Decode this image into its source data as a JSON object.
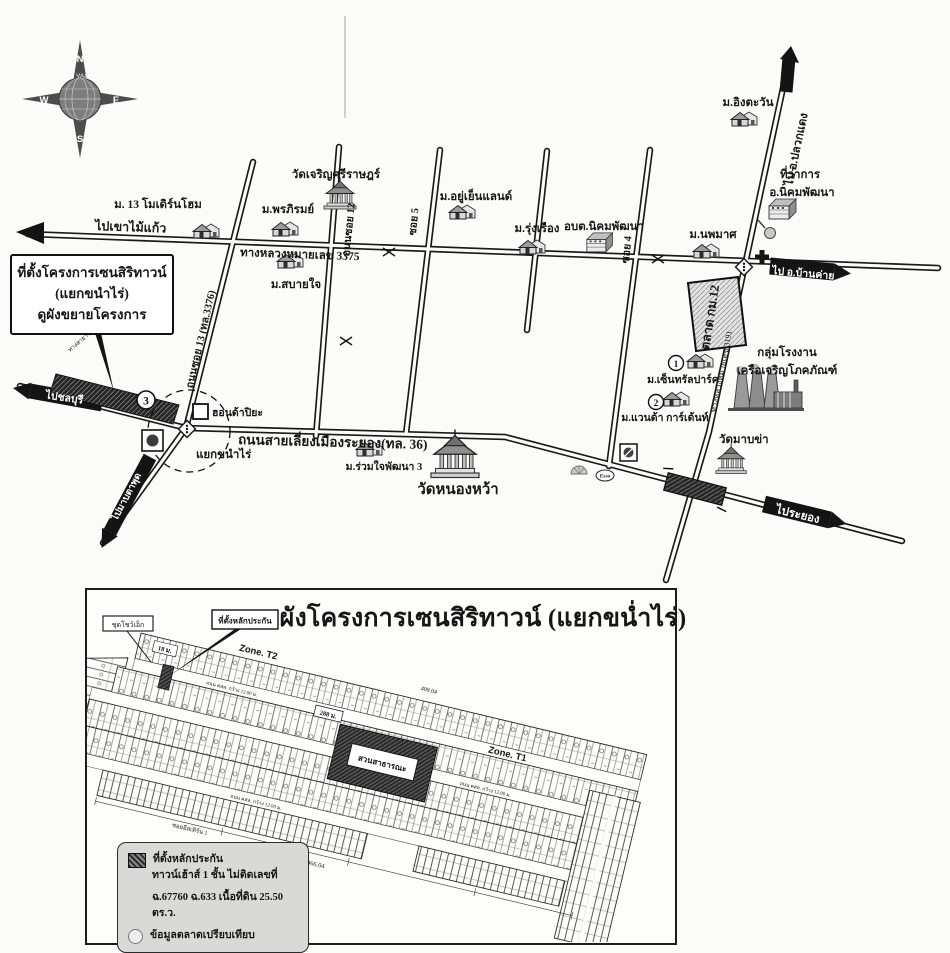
{
  "compass": {
    "n": "N",
    "e": "E",
    "s": "S",
    "w": "W",
    "brand": "WORLD VALUATION"
  },
  "map": {
    "callout": {
      "line1": "ที่ตั้งโครงการเซนสิริทาวน์",
      "line2": "(แยกขนำไร่)",
      "line3": "ดูผังขยายโครงการ"
    },
    "roads": {
      "hwy3375": "ทางหลวงหมายเลข 3375",
      "soi13": "ถนนซอย 13 (ทล.3376)",
      "soi12": "ถนนซอย 12",
      "soi5": "ซอย 5",
      "soi4": "ซอย 4",
      "hwy3191": "ทางหลวงหมายเลข 3191",
      "bypass": "ถนนสายเลี่ยงเมืองระยอง(ทล. 36)",
      "frontage": "ทางสาธารณประโยชน์"
    },
    "dir": {
      "khaomaikaeo": "ไปเขาไม้แก้ว",
      "pluakdaeng": "ไป อ.ปลวกแดง",
      "bankhai": "ไป อ.บ้านค่าย",
      "rayong": "ไประยอง",
      "chonburi": "ไปชลบุรี",
      "maptaphut": "ไปมาบตาพุด"
    },
    "poi": {
      "modernhome": "ม. 13 โมเดิร์นโฮม",
      "watcharoen": "วัดเจริญศรีราษฎร์",
      "pornpirom": "ม.พรภิรมย์",
      "sabaijai": "ม.สบายใจ",
      "yuyenland": "ม.อยู่เย็นแลนด์",
      "rungrueang": "ม.รุ่งเรือง",
      "obt": "อบต.นิคมพัฒนา",
      "ingtawan": "ม.อิงตะวัน",
      "district_line1": "ที่ว่าการ",
      "district_line2": "อ.นิคมพัฒนา",
      "noppamas": "ม.นพมาศ",
      "market": "ตลาด กม.12",
      "cp_line1": "กลุ่มโรงงาน",
      "cp_line2": "เครือเจริญโภคภัณฑ์",
      "centralpark": "ม.เซ็นทรัลปาร์ค",
      "wanda": "ม.แวนด้า การ์เด้นท์",
      "watmabkha": "วัดมาบข่า",
      "ruamjai": "ม.ร่วมใจพัฒนา 3",
      "watnongwa": "วัดหนองหว้า",
      "honda": "ฮอนด้าปิยะ",
      "junction": "แยกขนำไร่",
      "esso": "Esso"
    },
    "badges": {
      "one": "1",
      "two": "2",
      "three": "3"
    }
  },
  "plan": {
    "title": "ผังโครงการเซนสิริทาวน์ (แยกขน่ำไร่)",
    "labels": {
      "security": "ที่ตั้งหลักประกัน",
      "showunit": "ชุดโชว์เอ็ก",
      "zone_t2": "Zone. T2",
      "zone_t1": "Zone. T1",
      "park": "สวนสาธารณะ",
      "d288": "288 ม.",
      "d18": "18 ม.",
      "d6078": "60.78",
      "d40804": "408.04",
      "d46604": "466.04",
      "roadw": "ถนน คสล. กว้าง 12.00 ม.",
      "soi_bottom": "ซอยอีสเทิร์น 1"
    },
    "legend": {
      "security": "ที่ตั้งหลักประกัน",
      "desc1": "ทาวน์เฮ้าส์ 1 ชั้น ไม่ติดเลขที่",
      "desc2": "ฉ.67760 ฉ.633 เนื้อที่ดิน 25.50 ตร.ว.",
      "compare": "ข้อมูลตลาดเปรียบเทียบ"
    }
  },
  "colors": {
    "ink": "#1a1a1a",
    "paper": "#fbfbf9",
    "legend_bg": "#d9d9d7",
    "parcel": "#2b2b2b"
  }
}
